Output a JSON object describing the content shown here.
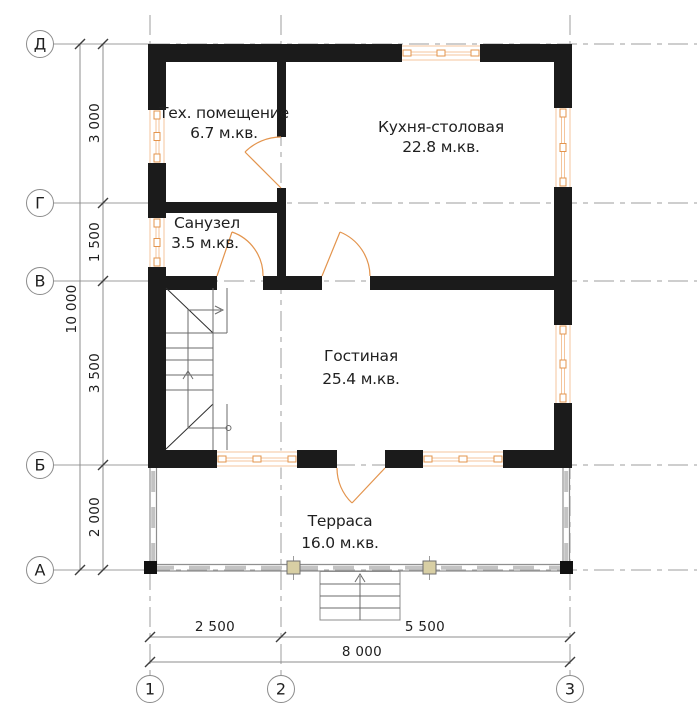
{
  "rooms": [
    {
      "name": "Тех. помещение",
      "area": "6.7 м.кв."
    },
    {
      "name": "Кухня-столовая",
      "area": "22.8 м.кв."
    },
    {
      "name": "Санузел",
      "area": "3.5 м.кв."
    },
    {
      "name": "Гостиная",
      "area": "25.4 м.кв."
    },
    {
      "name": "Терраса",
      "area": "16.0 м.кв."
    }
  ],
  "axes": {
    "rows": [
      {
        "label": "Д"
      },
      {
        "label": "Г"
      },
      {
        "label": "В"
      },
      {
        "label": "Б"
      },
      {
        "label": "А"
      }
    ],
    "cols": [
      {
        "label": "1"
      },
      {
        "label": "2"
      },
      {
        "label": "3"
      }
    ]
  },
  "dimensions": {
    "v_segments": [
      "3 000",
      "1 500",
      "3 500",
      "2 000"
    ],
    "v_total": "10 000",
    "h_segments": [
      "2 500",
      "5 500"
    ],
    "h_total": "8 000"
  },
  "colors": {
    "wall": "#1b1b1b",
    "joinery": "#e3944d",
    "joinery_light": "#f4c59c",
    "grid": "#9d9d9d",
    "dim": "#8c8c8c",
    "ink": "#1f1f1f",
    "rail": "#8f8f8f",
    "post_fill": "#d8cfa4"
  }
}
